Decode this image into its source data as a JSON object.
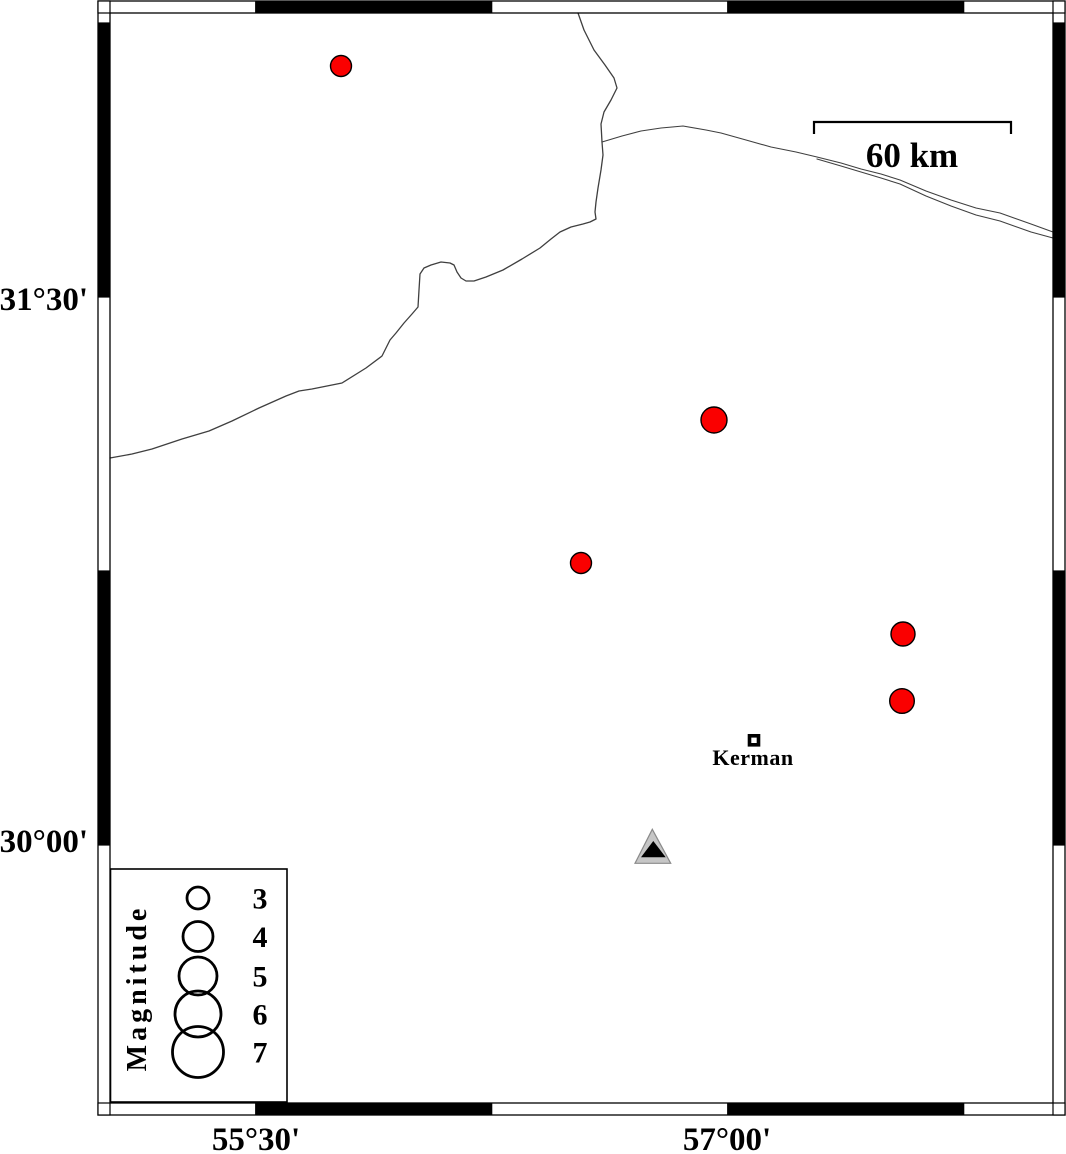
{
  "map": {
    "colors": {
      "epicenter_fill": "#fa0000",
      "outline": "#000000",
      "feature_line": "#3f3f3f",
      "station_fill": "#c6c6c6",
      "station_stroke": "#8a8a8a",
      "station_inner": "#000000",
      "frame_black": "#000000",
      "frame_white": "#ffffff"
    },
    "axis": {
      "left": [
        {
          "text": "31°30'",
          "x": 88,
          "y": 310
        },
        {
          "text": "30°00'",
          "x": 88,
          "y": 852
        }
      ],
      "bottom": [
        {
          "text": "55°30'",
          "x": 256,
          "y": 1150
        },
        {
          "text": "57°00'",
          "x": 727,
          "y": 1150
        }
      ]
    },
    "frame": {
      "outer": [
        98,
        1,
        1065,
        1115
      ],
      "inner": [
        110,
        13,
        1053,
        1103
      ],
      "band": 12,
      "x_boundaries": [
        255.7,
        491.7,
        727.7,
        963.7
      ],
      "y_boundaries": [
        23,
        297,
        571,
        845
      ],
      "x_black": [
        [
          255.7,
          491.7
        ],
        [
          727.7,
          963.7
        ]
      ],
      "y_black": [
        [
          23,
          297
        ],
        [
          571,
          845
        ]
      ]
    },
    "scale_bar": {
      "label": "60 km",
      "x1": 814,
      "x2": 1011,
      "y": 122,
      "tick_len": 12,
      "label_x": 912,
      "label_y": 167
    },
    "epicenters": [
      {
        "x": 341,
        "y": 66,
        "r": 10.5
      },
      {
        "x": 714,
        "y": 420,
        "r": 13
      },
      {
        "x": 581,
        "y": 563,
        "r": 10.5
      },
      {
        "x": 903,
        "y": 634,
        "r": 12
      },
      {
        "x": 902,
        "y": 701,
        "r": 12.3
      }
    ],
    "city": {
      "name": "Kerman",
      "x": 754,
      "y": 740.3,
      "size": 9,
      "border": 3.6,
      "label_x": 753,
      "label_y": 765
    },
    "station": {
      "outer": [
        [
          652.3,
          829.3
        ],
        [
          635,
          863.3
        ],
        [
          670.7,
          863.3
        ]
      ],
      "inner": [
        [
          653.3,
          841
        ],
        [
          641,
          857.3
        ],
        [
          665.7,
          857.3
        ]
      ]
    },
    "legend": {
      "title": "Magnitude",
      "title_x": 146,
      "title_y": 988,
      "box": [
        110.5,
        869,
        287,
        1102
      ],
      "circle_x": 198,
      "label_x": 260,
      "entries": [
        {
          "label": "3",
          "cy": 898,
          "r": 11
        },
        {
          "label": "4",
          "cy": 936.5,
          "r": 15
        },
        {
          "label": "5",
          "cy": 976,
          "r": 19
        },
        {
          "label": "6",
          "cy": 1014,
          "r": 23
        },
        {
          "label": "7",
          "cy": 1052,
          "r": 25.5
        }
      ]
    },
    "lines": {
      "north_branch": [
        [
          578,
          13
        ],
        [
          584,
          30
        ],
        [
          594,
          50
        ],
        [
          605,
          65
        ],
        [
          614,
          78
        ],
        [
          617,
          88
        ],
        [
          611,
          100
        ],
        [
          604,
          112
        ],
        [
          601,
          124
        ],
        [
          602,
          142
        ]
      ],
      "west_border": [
        [
          602,
          142
        ],
        [
          603,
          155
        ],
        [
          601,
          170
        ],
        [
          598,
          188
        ],
        [
          596,
          202
        ],
        [
          595,
          212
        ],
        [
          596,
          219
        ],
        [
          590,
          222
        ],
        [
          583,
          224
        ],
        [
          571,
          227
        ],
        [
          560,
          232
        ],
        [
          551,
          239
        ],
        [
          540,
          248
        ],
        [
          522,
          259
        ],
        [
          503,
          270
        ],
        [
          486,
          277
        ],
        [
          474,
          281
        ],
        [
          466,
          281
        ],
        [
          461,
          278
        ],
        [
          457,
          272
        ],
        [
          454,
          265
        ],
        [
          450,
          263
        ],
        [
          441,
          262
        ],
        [
          431,
          265
        ],
        [
          424,
          268
        ],
        [
          420,
          274
        ],
        [
          419,
          290
        ],
        [
          418,
          307
        ],
        [
          412,
          314
        ],
        [
          404,
          323
        ],
        [
          396,
          333
        ],
        [
          390,
          340
        ],
        [
          382,
          356
        ],
        [
          366,
          368
        ],
        [
          342,
          383
        ],
        [
          312,
          389
        ],
        [
          299,
          391
        ],
        [
          286,
          396
        ],
        [
          259,
          408
        ],
        [
          232,
          421
        ],
        [
          209,
          431
        ],
        [
          182,
          439
        ],
        [
          152,
          449
        ],
        [
          132,
          454
        ],
        [
          110,
          458
        ]
      ],
      "east_river_upper": [
        [
          602,
          142
        ],
        [
          622,
          136
        ],
        [
          641,
          131
        ],
        [
          661,
          128
        ],
        [
          683,
          126
        ],
        [
          706,
          130
        ],
        [
          721,
          133
        ],
        [
          746,
          140
        ],
        [
          771,
          147
        ],
        [
          796,
          152
        ],
        [
          817,
          157
        ],
        [
          841,
          163
        ],
        [
          861,
          169
        ],
        [
          881,
          174
        ],
        [
          900,
          180
        ],
        [
          926,
          191
        ],
        [
          951,
          200
        ],
        [
          976,
          208
        ],
        [
          1000,
          213
        ],
        [
          1031,
          224
        ],
        [
          1053,
          232
        ]
      ],
      "east_river_lower": [
        [
          817,
          159
        ],
        [
          841,
          166
        ],
        [
          861,
          172
        ],
        [
          881,
          178
        ],
        [
          900,
          184
        ],
        [
          926,
          196
        ],
        [
          951,
          206
        ],
        [
          976,
          215
        ],
        [
          1000,
          221
        ],
        [
          1031,
          232
        ],
        [
          1053,
          238
        ]
      ]
    }
  }
}
